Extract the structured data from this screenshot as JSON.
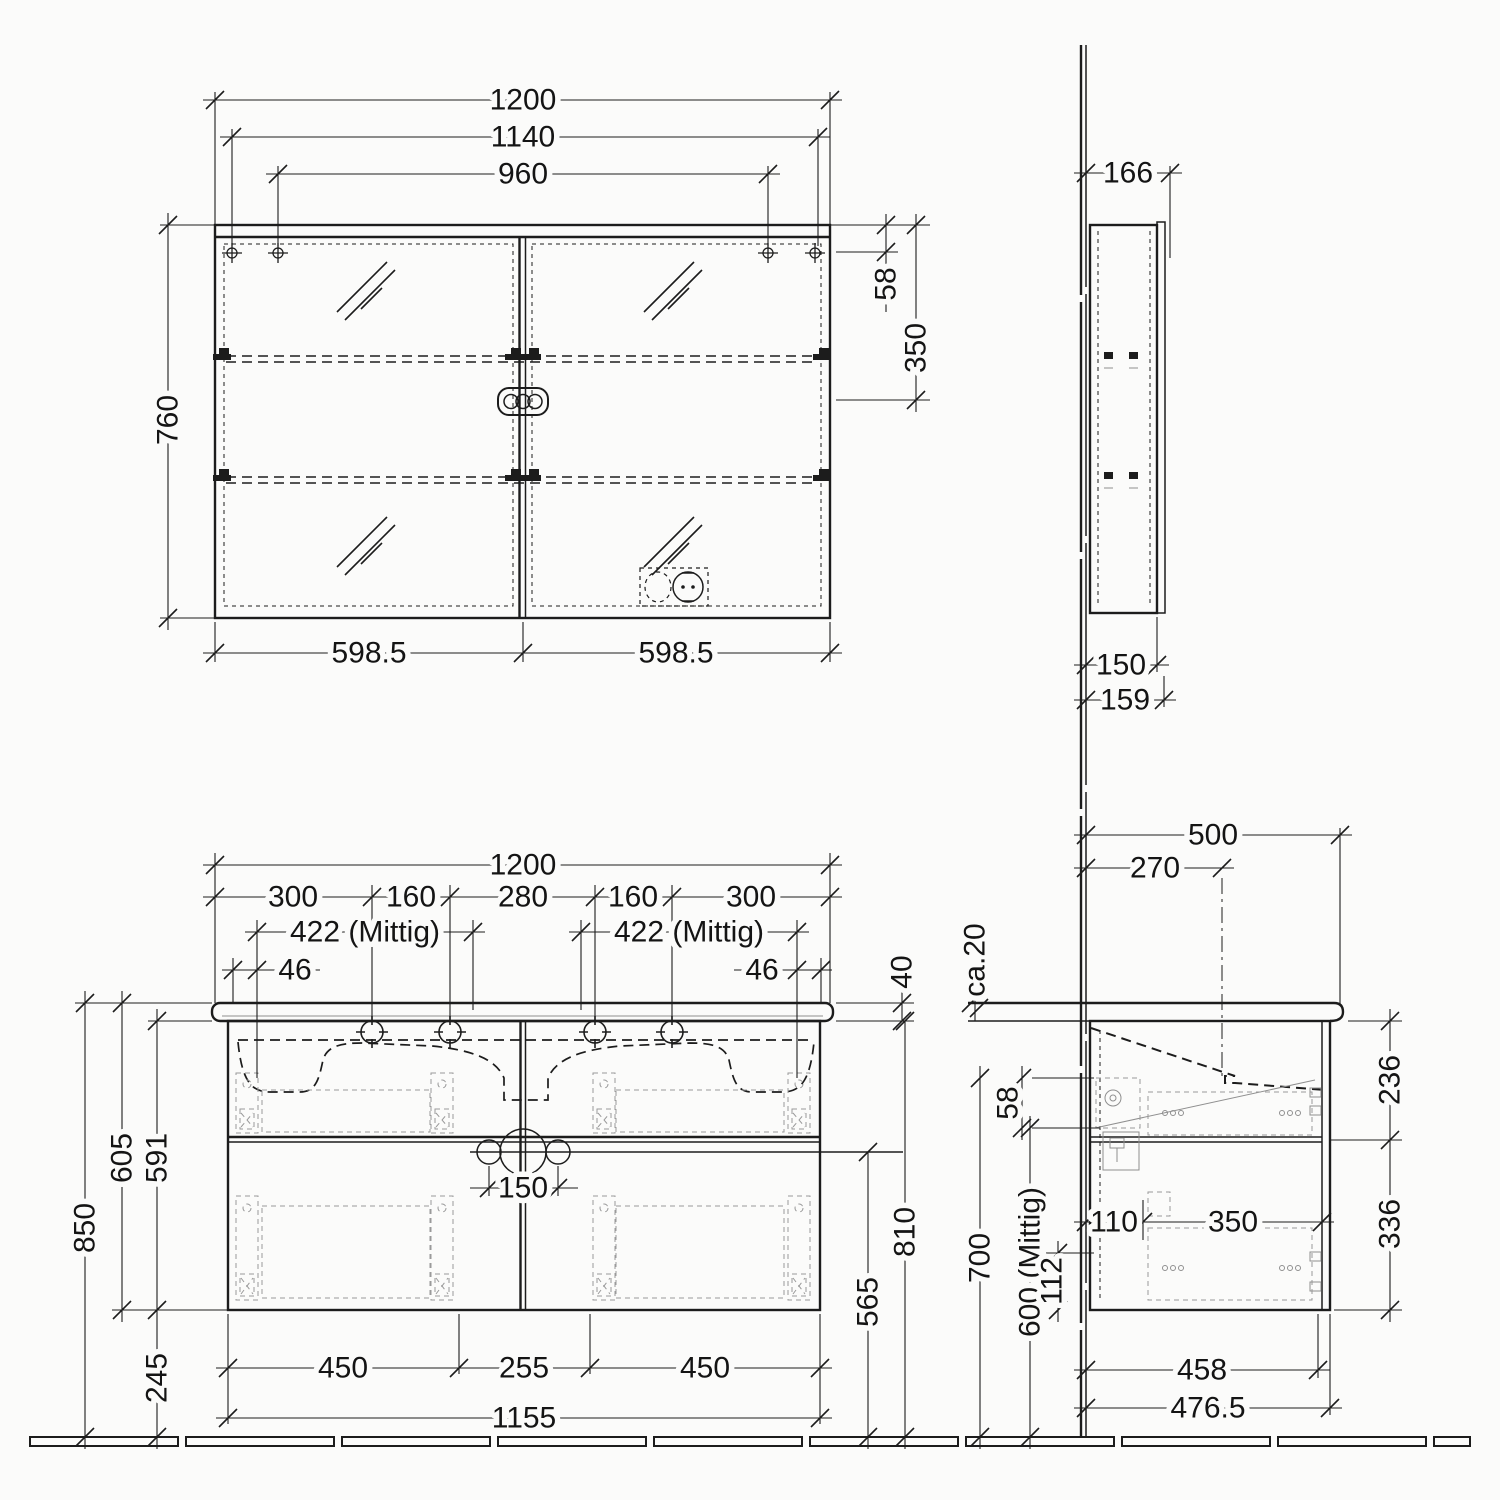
{
  "drawing_title": "bathroom-vanity-and-mirror-cabinet-dimension-drawing",
  "units": "mm",
  "mf": {
    "w1200": "1200",
    "w1140": "1140",
    "w960": "960",
    "h760": "760",
    "o58": "58",
    "h350": "350",
    "door_left": "598.5",
    "door_right": "598.5"
  },
  "ms": {
    "d166": "166",
    "d150": "150",
    "d159": "159"
  },
  "vf": {
    "w1200": "1200",
    "s300l": "300",
    "s160l": "160",
    "s280": "280",
    "s160r": "160",
    "s300r": "300",
    "mittig_l": "422 (Mittig)",
    "mittig_r": "422 (Mittig)",
    "e46l": "46",
    "e46r": "46",
    "t40": "40",
    "h850": "850",
    "h605": "605",
    "h591": "591",
    "h245": "245",
    "b450l": "450",
    "b255": "255",
    "b450r": "450",
    "w1155": "1155",
    "c150": "150",
    "h565": "565",
    "h810": "810"
  },
  "vs": {
    "d500": "500",
    "d270": "270",
    "ca20": "ca.20",
    "o58": "58",
    "h700": "700",
    "mittig600": "600 (Mittig)",
    "o112": "112",
    "d110": "110",
    "d350": "350",
    "h236": "236",
    "h336": "336",
    "d458": "458",
    "d476": "476.5"
  }
}
